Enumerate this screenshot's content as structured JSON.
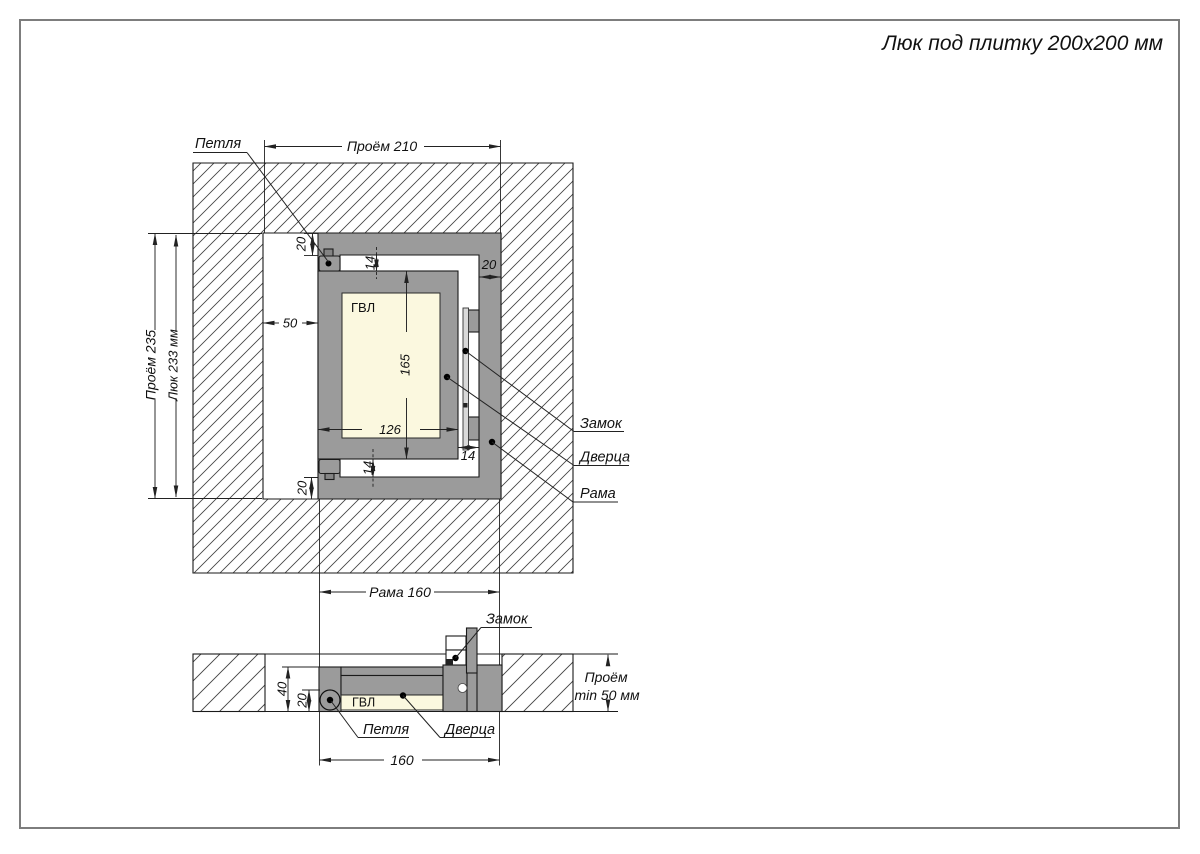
{
  "title": "Люк под плитку 200x200 мм",
  "front_view": {
    "dim_opening_width": "Проём 210",
    "dim_opening_height": "Проём 235",
    "dim_hatch_height": "Люк 233 мм",
    "dim_frame_width": "Рама 160",
    "dim_left_gap": "50",
    "dim_profile_top": "20",
    "dim_profile_right": "20",
    "dim_profile_bottom": "20",
    "dim_gap_top": "14",
    "dim_gap_bottom": "14",
    "dim_gap_right": "14",
    "dim_door_height": "165",
    "dim_door_width": "126",
    "label_gvl": "ГВЛ",
    "label_hinge": "Петля",
    "label_lock": "Замок",
    "label_door": "Дверца",
    "label_frame": "Рама"
  },
  "section_view": {
    "label_lock": "Замок",
    "dim_depth_total": "40",
    "dim_depth_door": "20",
    "label_gvl": "ГВЛ",
    "label_hinge": "Петля",
    "label_door": "Дверца",
    "dim_frame_width": "160",
    "dim_opening_depth_line1": "Проём",
    "dim_opening_depth_line2": "min 50 мм"
  },
  "colors": {
    "frame_gray": "#9b9b9b",
    "nub_gray": "#848484",
    "gvl_cream": "#fbf8df",
    "lock_strip": "#d9d9d9",
    "hatch_line": "#444444",
    "outline": "#1a1a1a",
    "dimension": "#222222",
    "page_border": "#7d7d7d"
  }
}
